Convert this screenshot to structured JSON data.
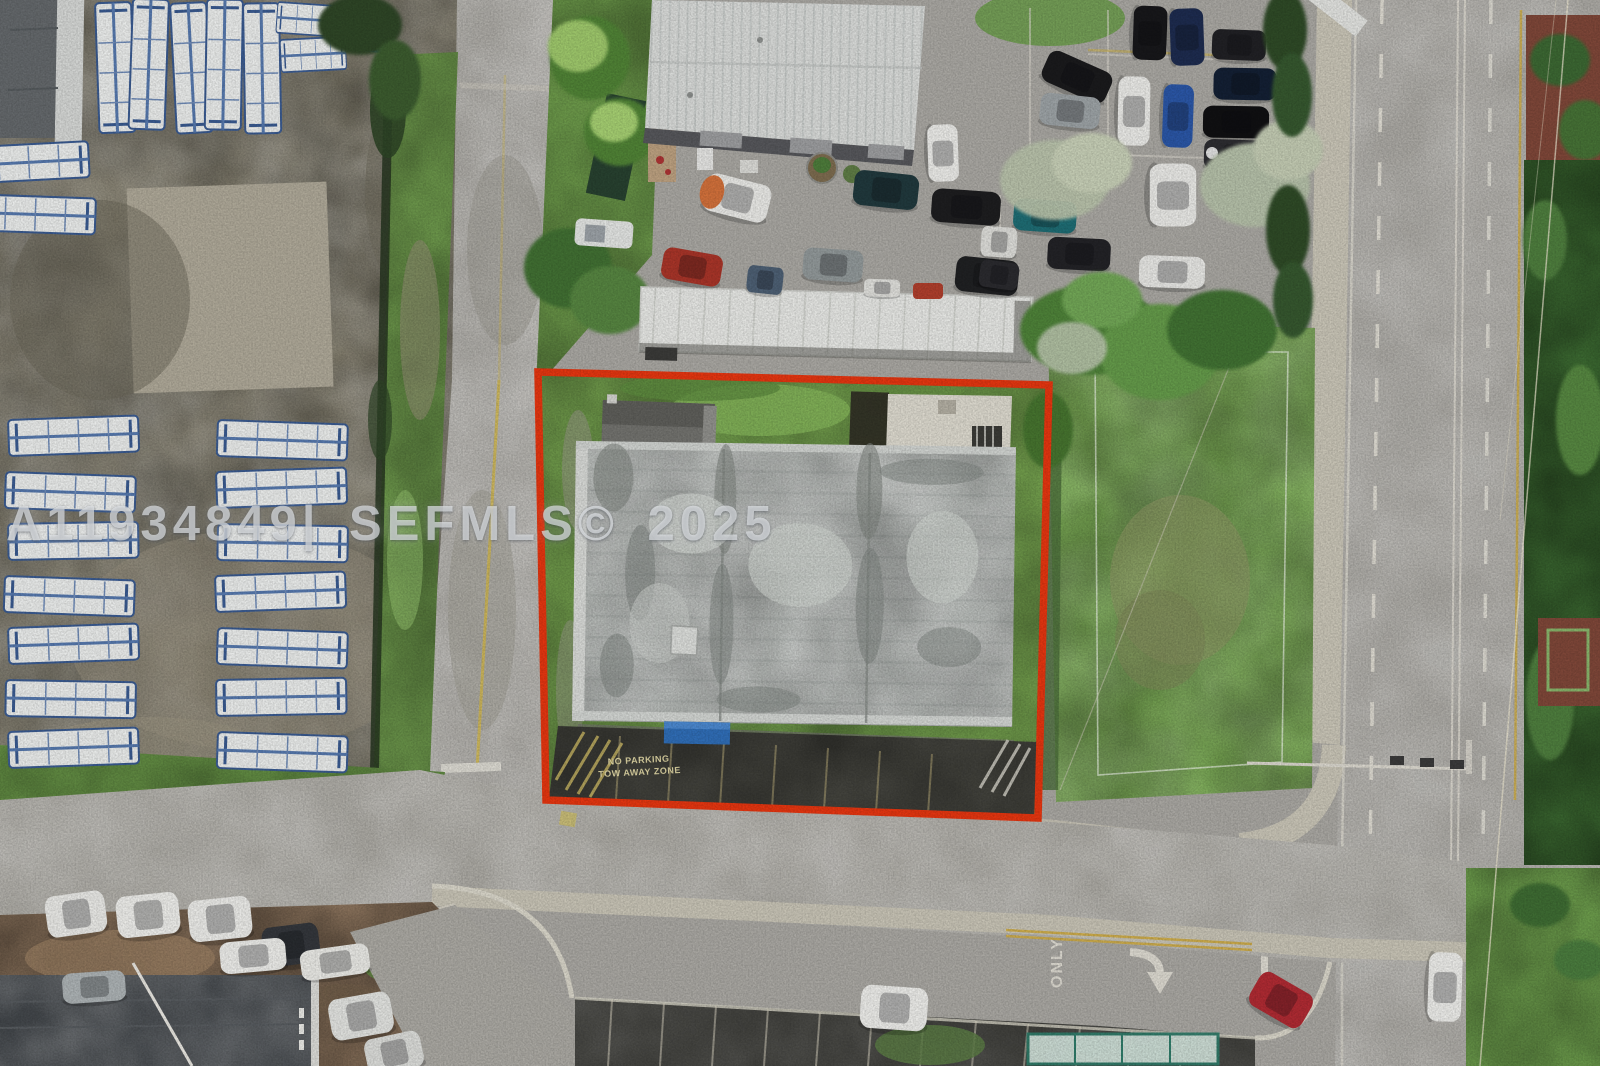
{
  "watermark": {
    "text": "A11934849| SEFMLS© 2025"
  },
  "painted_road_text": {
    "no_parking_line1": "NO PARKING",
    "no_parking_line2": "TOW AWAY ZONE",
    "lane_label": "ONLY"
  },
  "icons": {
    "turn_arrow": "right-turn-arrow"
  },
  "colors": {
    "property_outline_red": "#e23510",
    "asphalt_road": "#a7a5a0",
    "dark_parking_lot": "#3b3b37",
    "grass_green": "#74a04e",
    "dirt_yard": "#7e7969",
    "warehouse_roof_white": "#d6d8d6",
    "flat_roof_gray": "#b3b7b4",
    "trailer_blue": "#3f63a0",
    "center_line_yellow": "#c9a94b",
    "sidewalk_concrete": "#c6c2b4",
    "mulch_red_brown": "#7d4638",
    "hedge_dark_green": "#2d4a28"
  }
}
